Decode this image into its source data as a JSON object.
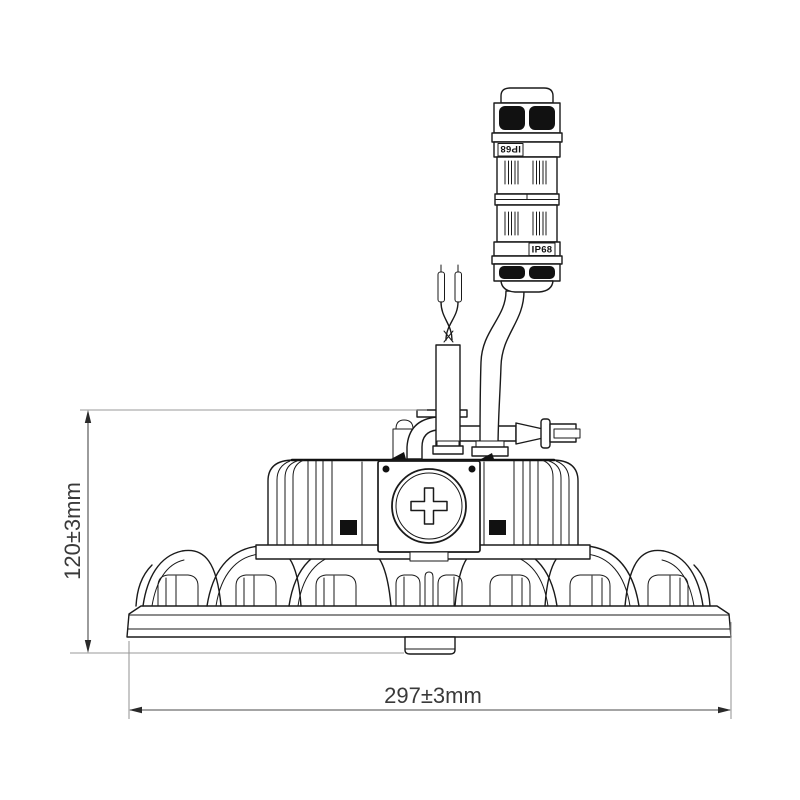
{
  "diagram": {
    "type": "technical-line-drawing",
    "subject": "ufo-highbay-light-side-view",
    "dimensions": {
      "height": "120±3mm",
      "width": "297±3mm"
    },
    "connector": {
      "top_label": "IP68",
      "bottom_label": "IP68"
    },
    "colors": {
      "background": "#ffffff",
      "line": "#1a1a1a",
      "fill_dark": "#111111",
      "extension_line": "#9a9a9a",
      "dimension_line": "#4a4a4a",
      "dimension_text": "#3a3a3a"
    }
  }
}
